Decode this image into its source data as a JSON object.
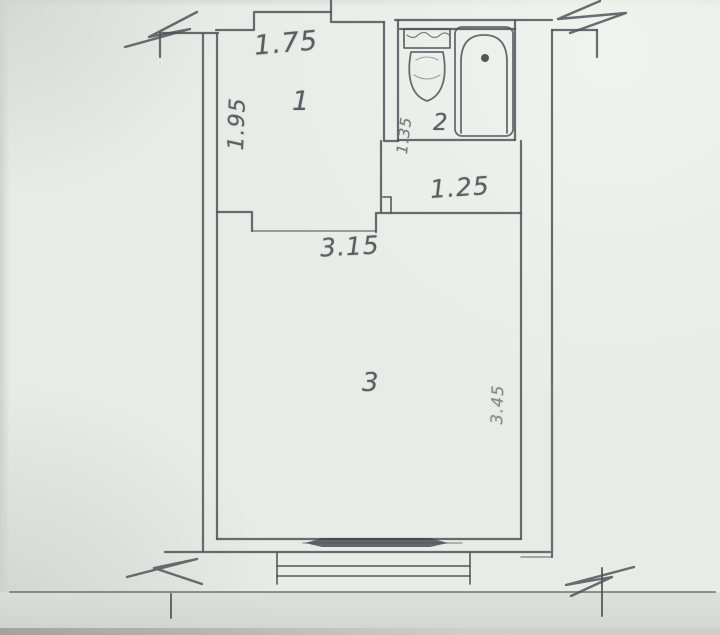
{
  "diagram": {
    "type": "hand-drawn apartment floor plan sketch",
    "rooms": [
      {
        "id": "room-1",
        "label": "1"
      },
      {
        "id": "room-2",
        "label": "2"
      },
      {
        "id": "room-3",
        "label": "3"
      }
    ],
    "dimensions": {
      "room1_width": "1.75",
      "room1_depth": "1.95",
      "bath_side": "1.35",
      "hall_width": "1.25",
      "room3_width": "3.15",
      "room3_depth": "3.45"
    },
    "fixtures": [
      {
        "name": "toilet"
      },
      {
        "name": "bathtub"
      }
    ],
    "symbols": [
      {
        "name": "wall-break",
        "count": 4
      },
      {
        "name": "window-balcony-door"
      },
      {
        "name": "entry-steps"
      }
    ],
    "colors": {
      "paper": "#e8ebe6",
      "pencil": "#50545a",
      "pencil_soft": "#73777c",
      "window_fill": "#41454b",
      "text": "#5a5e63"
    }
  }
}
